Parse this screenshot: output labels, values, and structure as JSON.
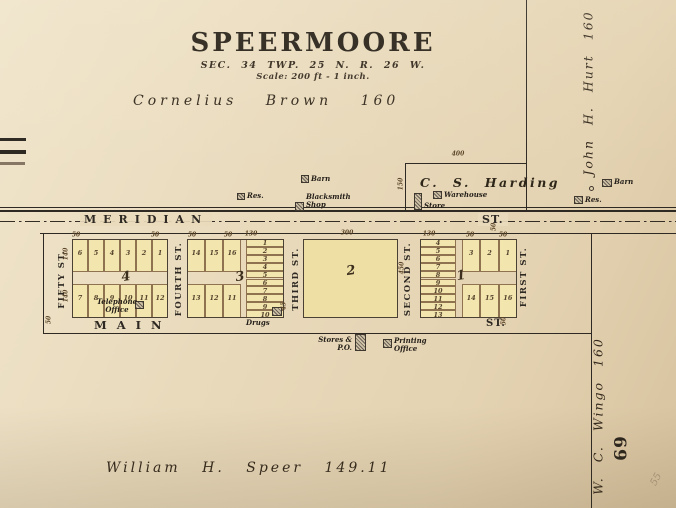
{
  "title": {
    "main": "SPEERMOORE",
    "line2": "SEC. 34 TWP. 25 N. R. 26 W.",
    "line3": "Scale: 200 ft - 1 inch."
  },
  "owners": {
    "north": "Cornelius Brown 160",
    "east": "John H. Hurt 160",
    "southeast": "W. C. Wingo 160",
    "south": "William H. Speer 149.11",
    "harding": "C. S. Harding"
  },
  "page_number": "69",
  "pencil_note": "55",
  "streets": {
    "meridian": "MERIDIAN",
    "meridian_st": "ST.",
    "main": "MAIN",
    "main_st": "ST.",
    "fifth": "FIFTY ST.",
    "fourth": "FOURTH ST.",
    "third": "THIRD ST.",
    "second": "SECOND ST.",
    "first": "FIRST ST."
  },
  "blocks": {
    "b4": {
      "label": "4",
      "top": [
        "6",
        "5",
        "4",
        "3",
        "2",
        "1"
      ],
      "bottom": [
        "7",
        "8",
        "9",
        "10",
        "11",
        "12"
      ]
    },
    "b3": {
      "label": "3",
      "left_top": [
        "14",
        "15",
        "16"
      ],
      "left_bottom": [
        "13",
        "12",
        "11"
      ],
      "column": [
        "1",
        "2",
        "3",
        "4",
        "5",
        "6",
        "7",
        "8",
        "9",
        "10"
      ]
    },
    "b2": {
      "label": "2"
    },
    "b1": {
      "label": "1",
      "column": [
        "4",
        "5",
        "6",
        "7",
        "8",
        "9",
        "10",
        "11",
        "12",
        "13"
      ],
      "right_top": [
        "3",
        "2",
        "1"
      ],
      "right_bottom": [
        "14",
        "15",
        "16"
      ]
    }
  },
  "buildings": [
    {
      "name": "res-west",
      "lines": [
        "Res."
      ]
    },
    {
      "name": "barn-west",
      "lines": [
        "Barn"
      ]
    },
    {
      "name": "blacksmith-shop",
      "lines": [
        "Blacksmith",
        "Shop"
      ]
    },
    {
      "name": "warehouse",
      "lines": [
        "Warehouse"
      ]
    },
    {
      "name": "store",
      "lines": [
        "Store"
      ]
    },
    {
      "name": "barn-east",
      "lines": [
        "Barn"
      ]
    },
    {
      "name": "res-east",
      "lines": [
        "Res."
      ]
    },
    {
      "name": "telephone-office",
      "lines": [
        "Telephone",
        "Office"
      ]
    },
    {
      "name": "drugs",
      "lines": [
        "Drugs"
      ]
    },
    {
      "name": "stores-po",
      "lines": [
        "Stores &",
        "P.O."
      ]
    },
    {
      "name": "printing-office",
      "lines": [
        "Printing",
        "Office"
      ]
    }
  ],
  "dimensions": [
    "400",
    "150",
    "300",
    "450",
    "130",
    "130",
    "50",
    "50",
    "50",
    "50",
    "50",
    "50",
    "50",
    "50",
    "50",
    "140",
    "140",
    "45"
  ]
}
